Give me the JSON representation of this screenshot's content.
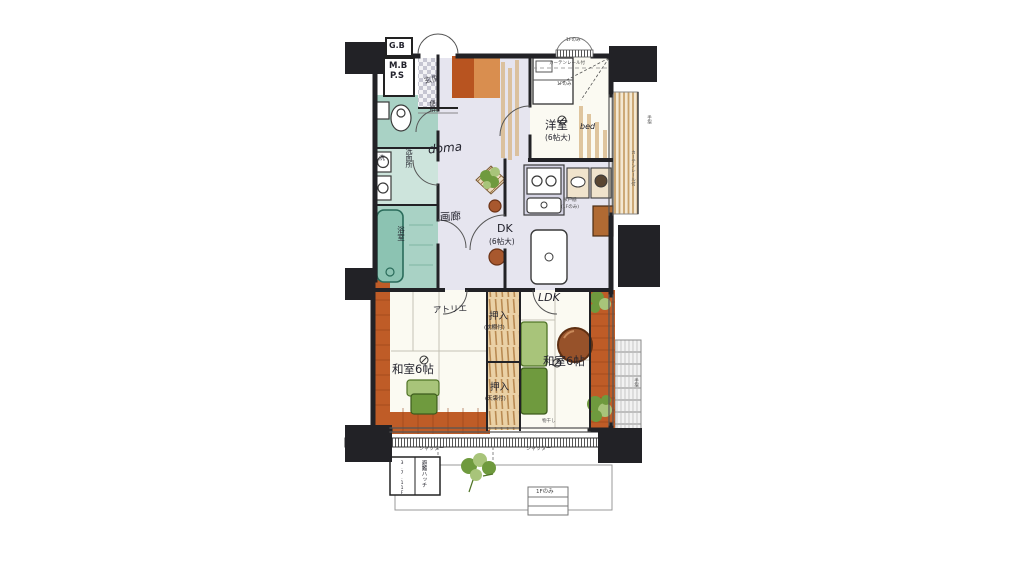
{
  "plan": {
    "upper_left": {
      "gb": "G.B",
      "mb": "M.B",
      "ps": "P.S"
    },
    "entry": {
      "genkan": "玄関",
      "doma": "doma",
      "gallery": "画廊"
    },
    "sanitary": {
      "toilet": "便所",
      "washroom": "洗面所",
      "laundry": "洗",
      "bathroom": "浴室"
    },
    "bedroom": {
      "name": "洋室",
      "bed": "bed",
      "size": "(6帖大)",
      "curtain_note": "カーテンレール付",
      "floor_note": "1Fのみ"
    },
    "dk": {
      "name": "DK",
      "size": "(6帖大)",
      "cupboard": "吊戸棚",
      "cupboard_note": "(1Fのみ)"
    },
    "left_room": {
      "atelier": "アトリエ",
      "name": "和室6帖"
    },
    "right_room": {
      "ldk": "LDK",
      "name": "和室6帖"
    },
    "closets": {
      "name": "押入",
      "top_note": "(枕棚付)",
      "bottom_note": "(天袋付)"
    },
    "balcony": {
      "shutter": "シャッター",
      "handrail": "手摺",
      "drying": "物干し",
      "escape_hatch": "避難ハッチ",
      "escape_floors": "3.7.11F",
      "first_floor_only": "1Fのみ"
    }
  },
  "colors": {
    "wall": "#222226",
    "bath": "#a9d2c5",
    "bath_light": "#cde4dc",
    "corridor": "#e6e5ef",
    "wood": "#bf5c27",
    "wood_light": "#d98e4f",
    "tatami_mat": "#fbfaf2",
    "closet_tan": "#d8b88a",
    "greenery": "#6f9a3e",
    "greenery_light": "#a8c47a",
    "table_wood": "#97522a"
  }
}
